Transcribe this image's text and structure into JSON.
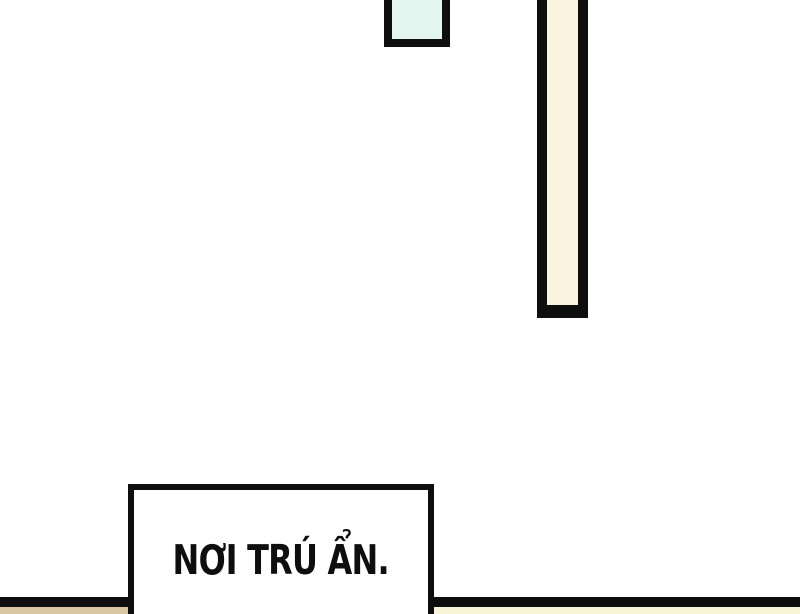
{
  "panel": {
    "type": "comic-panel",
    "caption": {
      "text": "NƠI TRÚ ẨN."
    },
    "colors": {
      "ink": "#0e0e0e",
      "background": "#ffffff",
      "pillar_fill": "#faf3e1",
      "window_fill": "#e5f6f1",
      "floor_strip_left_fill": "#d9c7a3",
      "floor_strip_right_fill": "#f8f4d8",
      "caption_fill": "#ffffff"
    }
  }
}
